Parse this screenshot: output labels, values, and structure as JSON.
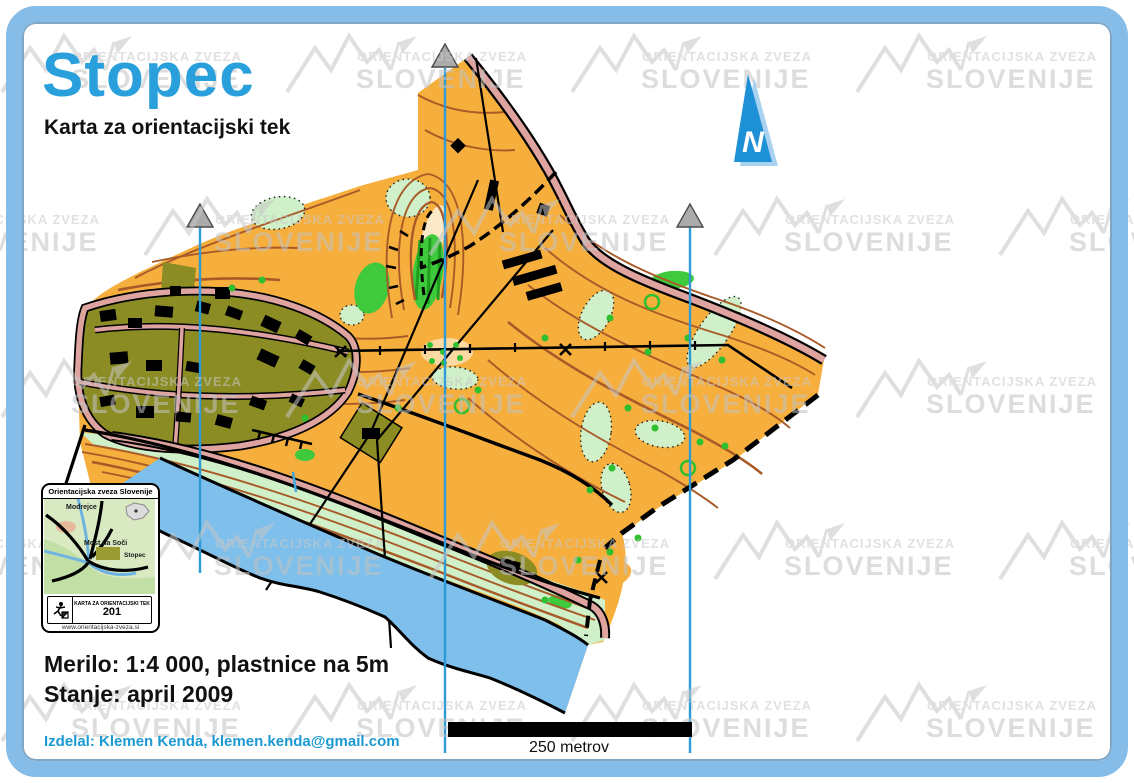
{
  "page": {
    "title": "Stopec",
    "subtitle": "Karta za orientacijski tek",
    "scale_text": "Merilo: 1:4 000, plastnice na 5m",
    "status_text": "Stanje: april 2009",
    "credit_text": "Izdelal: Klemen Kenda, klemen.kenda@gmail.com",
    "scale_bar_label": "250 metrov",
    "north_arrow_label": "N"
  },
  "watermark": {
    "line1": "ORIENTACIJSKA ZVEZA",
    "line2": "SLOVENIJE"
  },
  "inset": {
    "header": "Orientacijska zveza Slovenije",
    "label_modrejce": "Modrejce",
    "label_most_na_soci": "Most na Soči",
    "label_stopec": "Stopec",
    "footer_caption": "KARTA ZA ORIENTACIJSKI TEK",
    "footer_number": "201",
    "website": "www.orientacijska-zveza.si"
  },
  "colors": {
    "frame_blue": "#85BCE8",
    "title_blue": "#29A0DB",
    "credit_blue": "#1B9AD2",
    "open_land_orange": "#F6AE3C",
    "rough_open_pale": "#FBD9A0",
    "vegetation_light_green": "#CFF0C8",
    "vegetation_bright_green": "#3FC93C",
    "settlement_olive": "#8C8C25",
    "road_pink": "#DFA4A0",
    "contour_brown": "#A85A28",
    "river_blue": "#7FBFEB",
    "meridian_blue": "#2E9BD6",
    "north_arrow_blue": "#1E90D6",
    "watermark_gray": "#C6C6C6"
  }
}
